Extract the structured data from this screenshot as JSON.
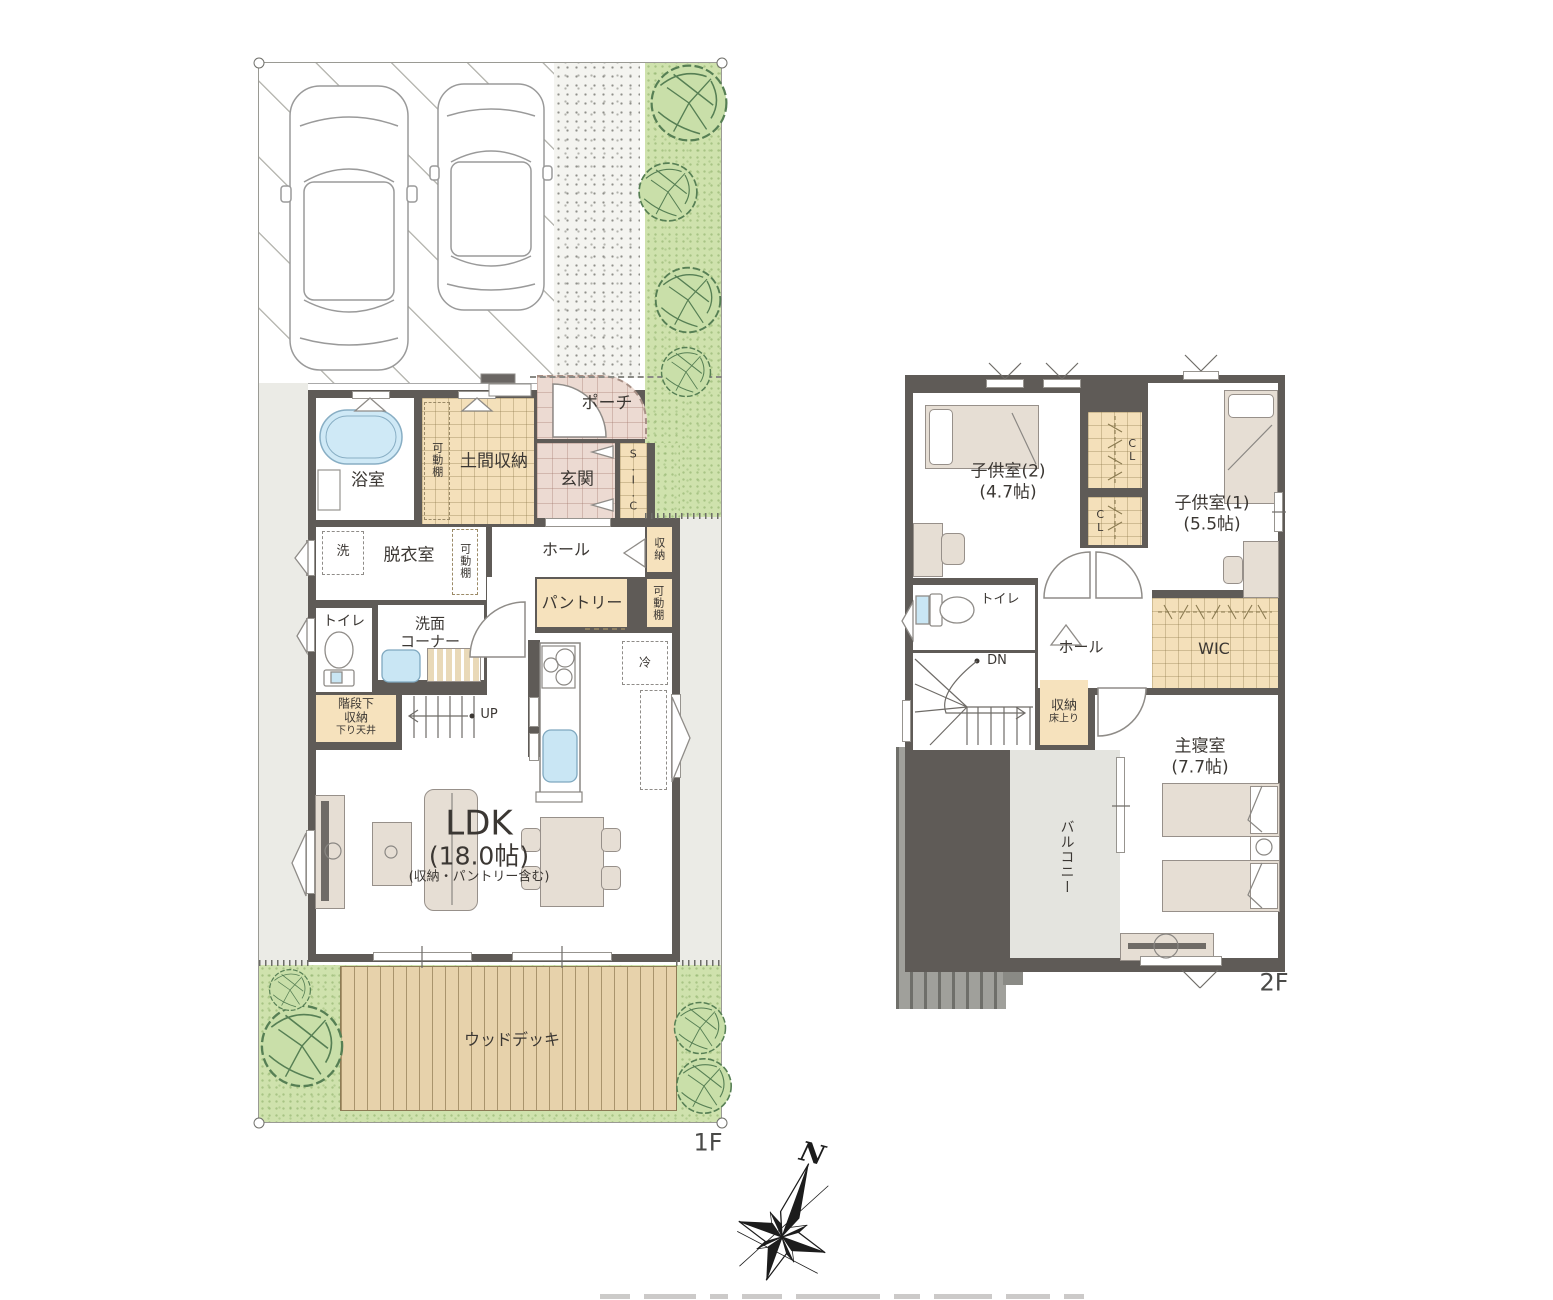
{
  "floor1": {
    "name": "1F",
    "rooms": {
      "bath": "浴室",
      "doma": "土間収納",
      "porch": "ポーチ",
      "genkan": "玄関",
      "sic": "S.I.C",
      "shelf": "可動棚",
      "wash": "洗",
      "datsui": "脱衣室",
      "hall": "ホール",
      "storage": "収納",
      "pantry": "パントリー",
      "toilet": "トイレ",
      "senmen1": "洗面",
      "senmen2": "コーナー",
      "stairstor1": "階段下",
      "stairstor2": "収納",
      "stairstor3": "下り天井",
      "up": "UP",
      "fridge": "冷",
      "ldk": "LDK",
      "ldk_size": "(18.0帖)",
      "ldk_note": "(収納・パントリー含む)",
      "deck": "ウッドデッキ"
    }
  },
  "floor2": {
    "name": "2F",
    "rooms": {
      "child2": "子供室(2)",
      "child2_size": "(4.7帖)",
      "child1": "子供室(1)",
      "child1_size": "(5.5帖)",
      "cl": "CL",
      "toilet": "トイレ",
      "hall": "ホール",
      "dn": "DN",
      "storage": "収納",
      "storage_note": "床上り",
      "wic": "WIC",
      "master": "主寝室",
      "master_size": "(7.7帖)",
      "balcony": "バルコニー"
    }
  },
  "compass": {
    "north": "N"
  },
  "colors": {
    "wall": "#5f5b57",
    "tatami_beige": "#f4e0ba",
    "tile_pink": "#ecdad2",
    "lawn_green": "#cfe2ad",
    "deck_tan": "#e7d2ab",
    "water_blue": "#c9e6f4",
    "balcony_gray": "#e4e4df",
    "roof_gray": "#a0a09b",
    "outside_gray": "#ebebe6",
    "furniture_beige": "#e6ded4"
  }
}
